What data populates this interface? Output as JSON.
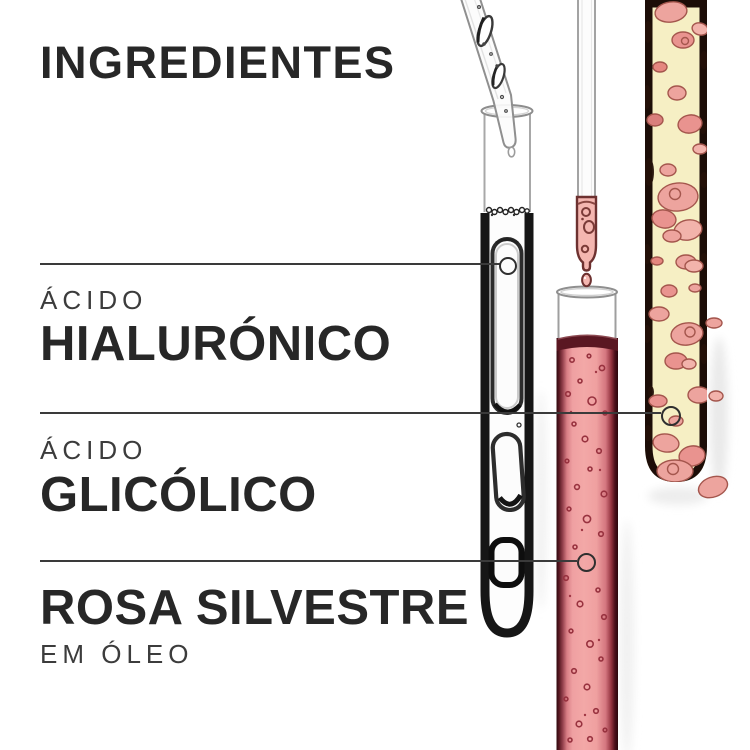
{
  "title": "INGREDIENTES",
  "ingredients": [
    {
      "prefix": "ÁCIDO",
      "name": "HIALURÓNICO"
    },
    {
      "prefix": "ÁCIDO",
      "name": "GLICÓLICO"
    },
    {
      "name": "ROSA SILVESTRE",
      "suffix": "EM ÓLEO"
    }
  ],
  "icons": [
    "test-tube-clear-gel-icon",
    "test-tube-pink-liquid-icon",
    "test-tube-yellow-oil-icon",
    "pipette-dropper-icon",
    "pipette-pink-drop-icon",
    "callout-ring-marker-icon"
  ],
  "colors": {
    "background": "#ffffff",
    "ink": "#272727",
    "ink_light": "#3c3c3c",
    "callout": "#3a3a3a",
    "pink_liquid": "#f2a1a1",
    "pink_liquid_edge": "#551620",
    "pink_blob": "#eda49e",
    "yellow_oil": "#f6efc4",
    "pipette_pink": "#f4b6b0",
    "glass_gray": "#9f9f9f"
  }
}
